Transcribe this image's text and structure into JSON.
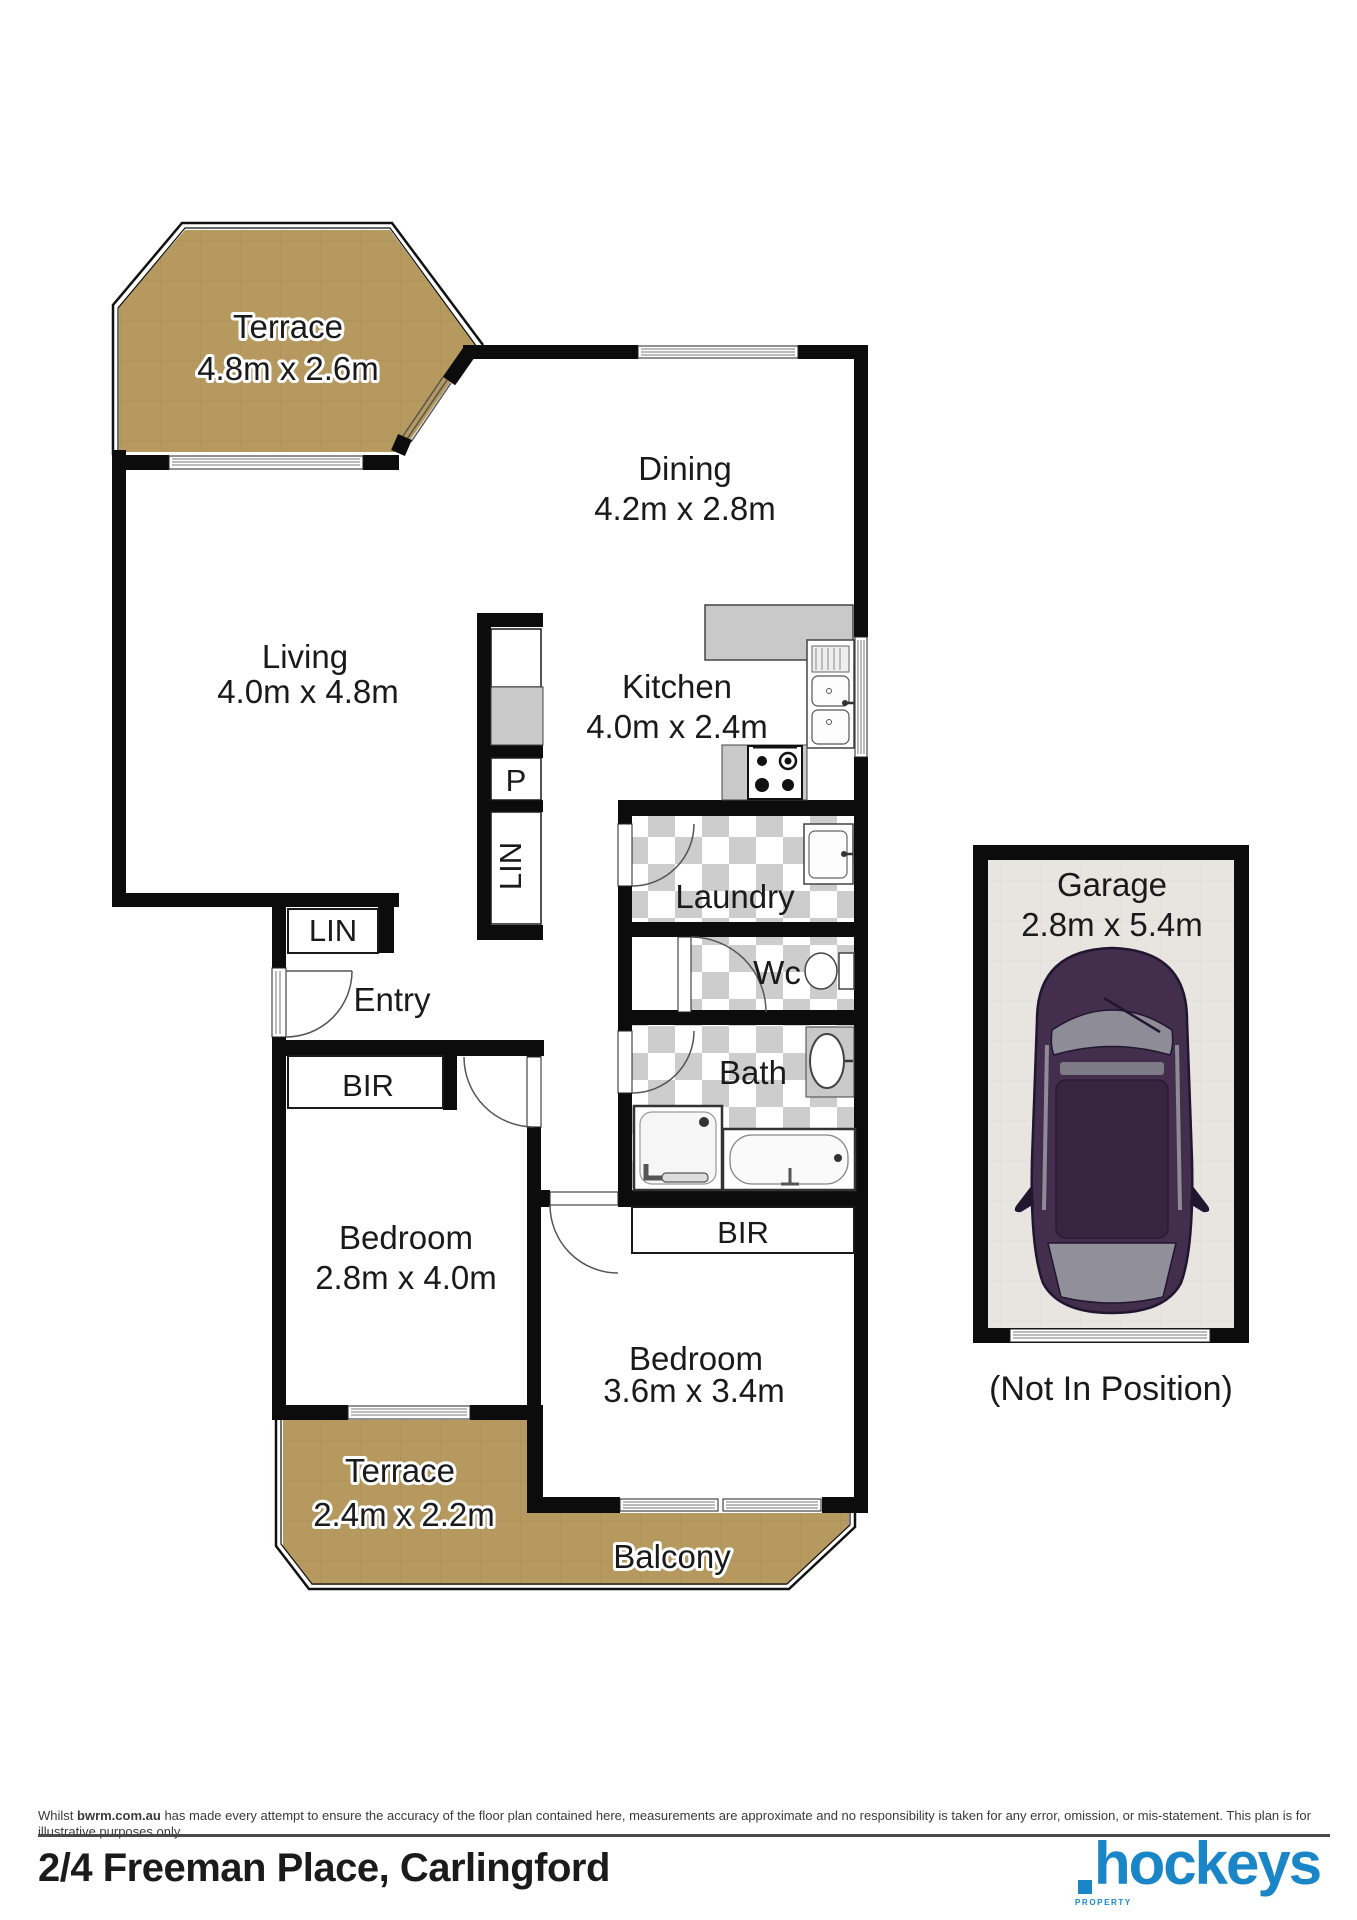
{
  "floor_plan": {
    "rooms": {
      "terrace1": {
        "name": "Terrace",
        "dims": "4.8m x 2.6m"
      },
      "dining": {
        "name": "Dining",
        "dims": "4.2m x 2.8m"
      },
      "living": {
        "name": "Living",
        "dims": "4.0m x 4.8m"
      },
      "kitchen": {
        "name": "Kitchen",
        "dims": "4.0m x 2.4m"
      },
      "pantry": {
        "name": "P"
      },
      "linen_hall": {
        "name": "LIN"
      },
      "laundry": {
        "name": "Laundry"
      },
      "wc": {
        "name": "Wc"
      },
      "bath": {
        "name": "Bath"
      },
      "linen_entry": {
        "name": "LIN"
      },
      "entry": {
        "name": "Entry"
      },
      "bir1": {
        "name": "BIR"
      },
      "bedroom1": {
        "name": "Bedroom",
        "dims": "2.8m x 4.0m"
      },
      "bir2": {
        "name": "BIR"
      },
      "bedroom2": {
        "name": "Bedroom",
        "dims": "3.6m x 3.4m"
      },
      "terrace2": {
        "name": "Terrace",
        "dims": "2.4m x 2.2m"
      },
      "balcony": {
        "name": "Balcony"
      },
      "garage": {
        "name": "Garage",
        "dims": "2.8m x 5.4m",
        "note": "(Not In Position)"
      }
    },
    "colors": {
      "terrace_tan": "#b6995f",
      "wall_black": "#0c0c0c",
      "checker_gray": "#cdcdcd",
      "fixture_gray": "#c9c9c9",
      "garage_floor": "#e8e5e1",
      "car_body": "#432e4d",
      "logo_blue": "#1a86c7"
    }
  },
  "footer": {
    "disclaimer_prefix": "Whilst",
    "disclaimer_bold": "bwrm.com.au",
    "disclaimer_rest": "has made every attempt to ensure the accuracy of the floor plan contained here, measurements are approximate and no responsibility is taken for any error, omission, or mis-statement. This plan is for illustrative purposes only.",
    "address": "2/4 Freeman Place, Carlingford",
    "logo": {
      "text": "hockeys",
      "sub": "PROPERTY"
    }
  }
}
